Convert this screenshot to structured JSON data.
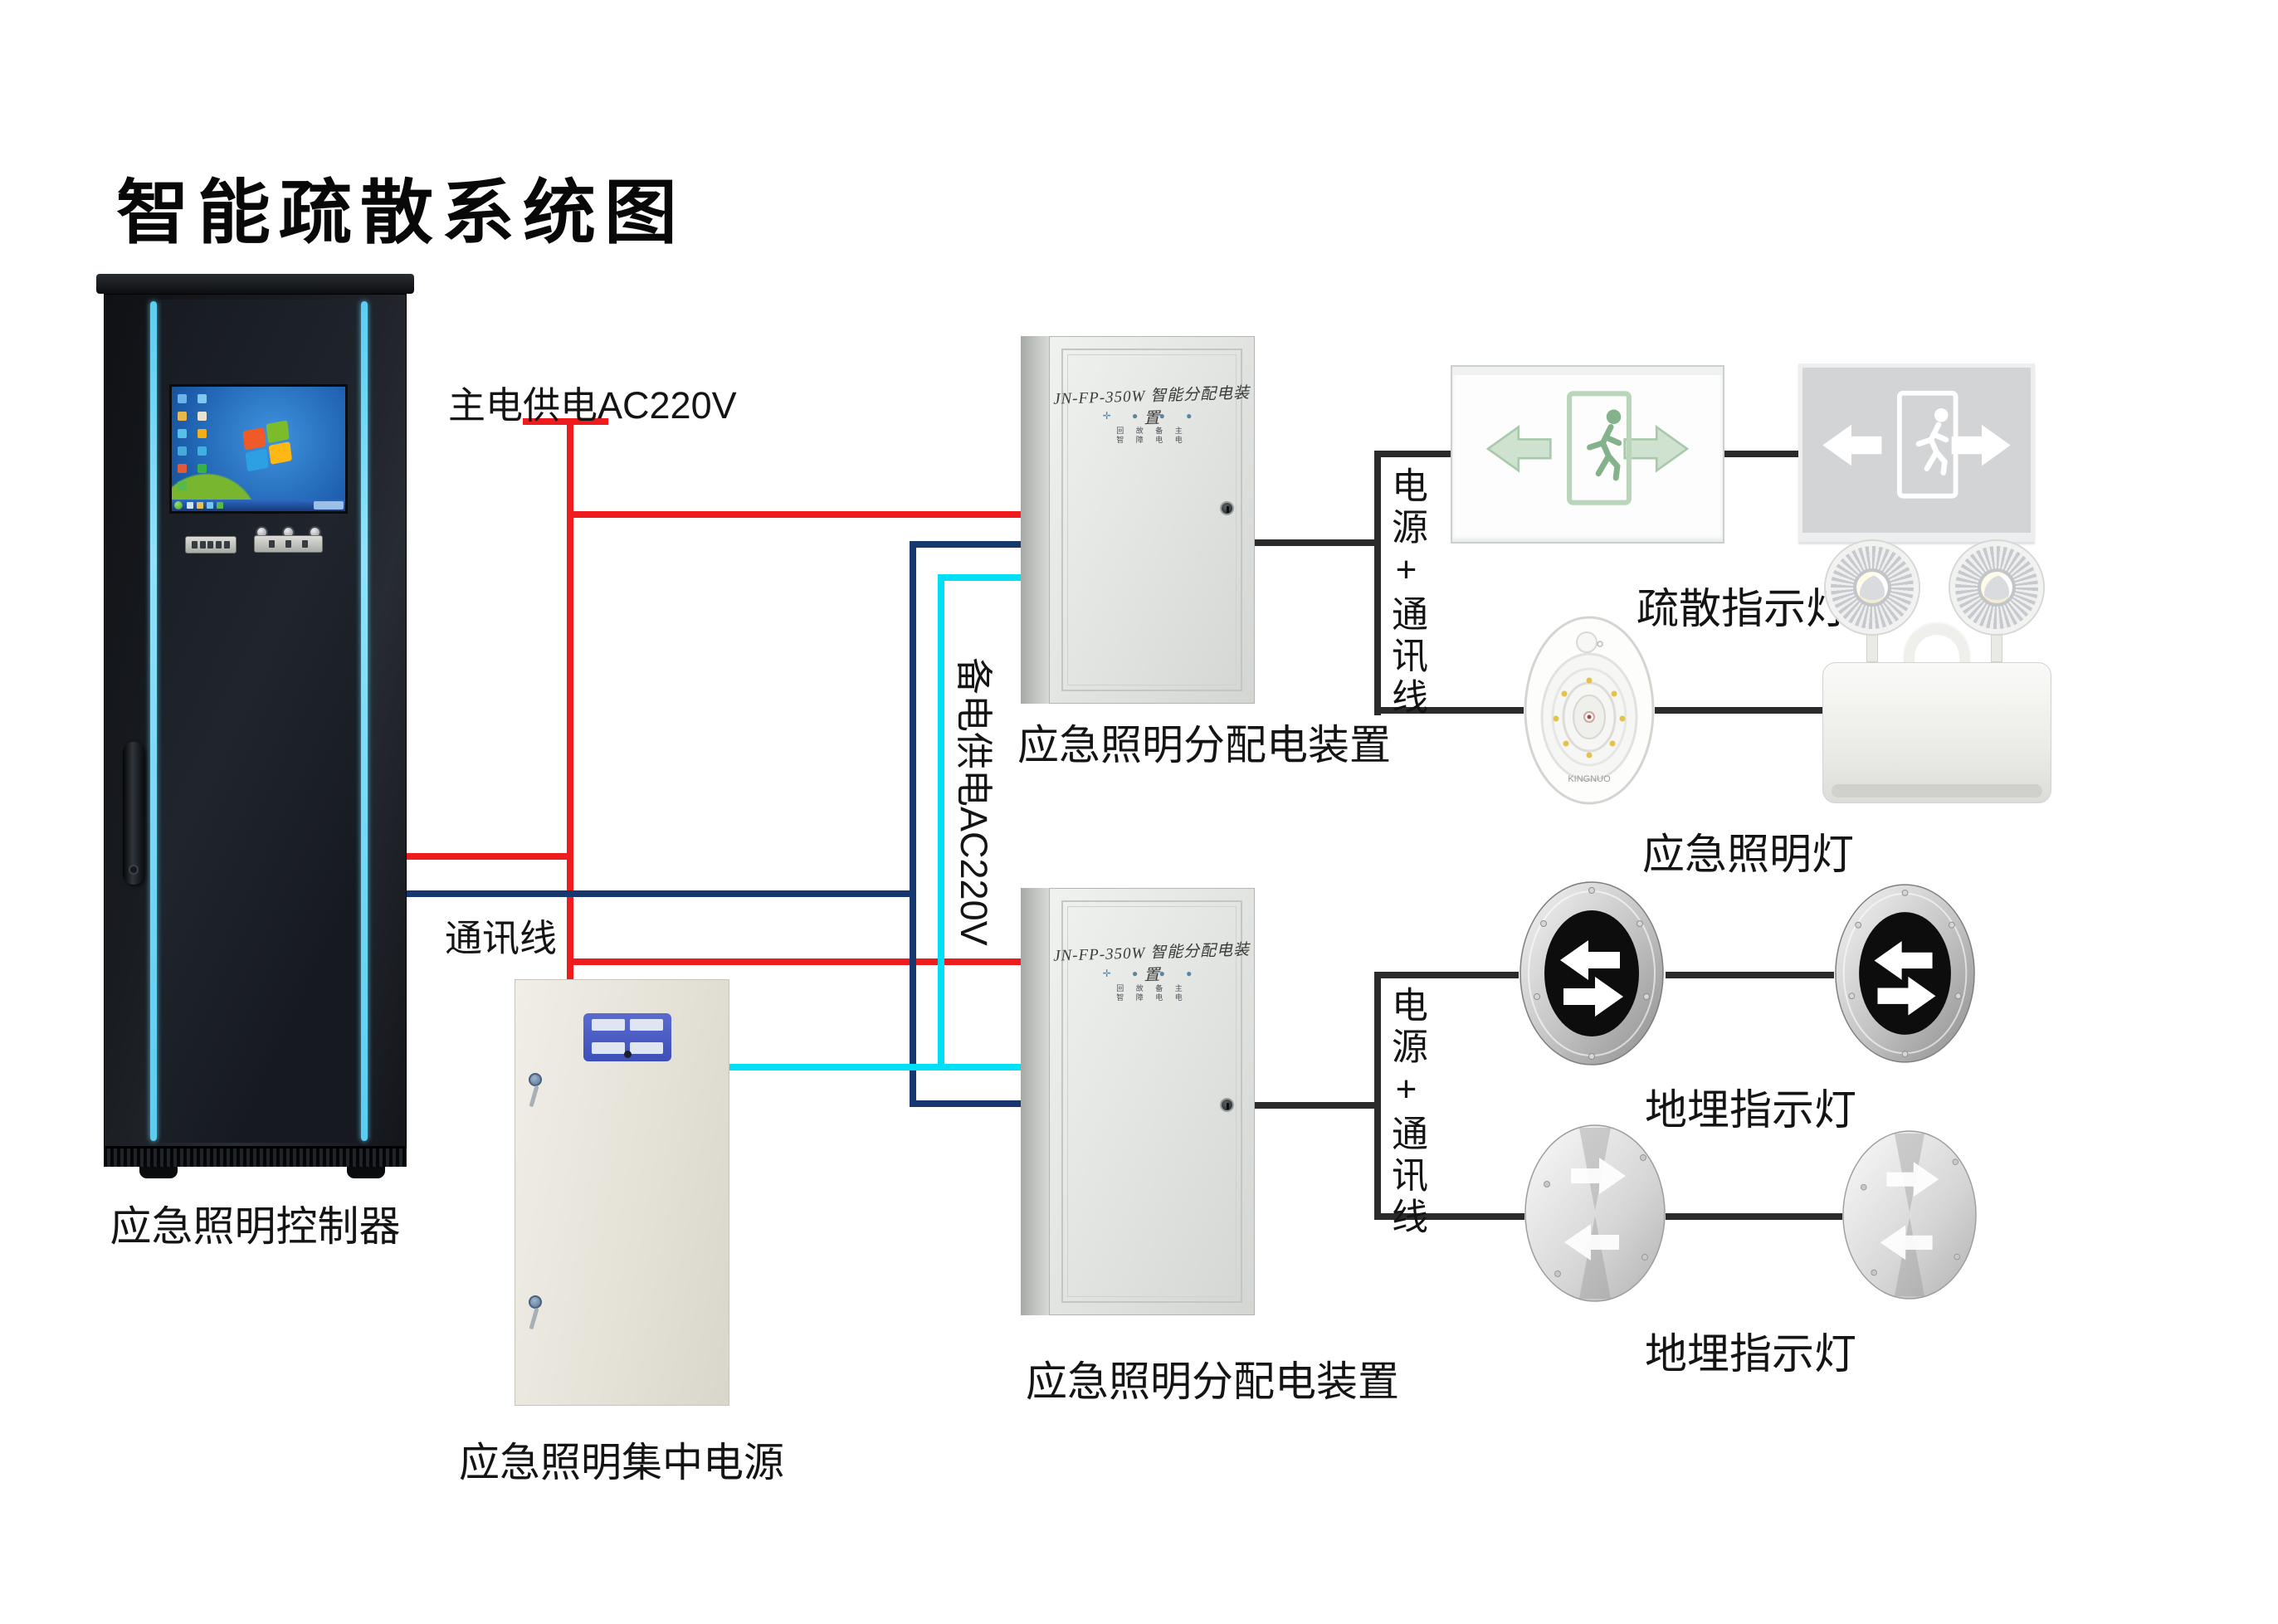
{
  "title": "智能疏散系统图",
  "annotations": {
    "main_power": "主电供电AC220V",
    "comm": "通讯线",
    "backup_power": "备电供电AC220V"
  },
  "cabinet": {
    "label": "应急照明控制器"
  },
  "central_power": {
    "label": "应急照明集中电源"
  },
  "dist_boxes": [
    {
      "model": "JN-FP-350W 智能分配电装置",
      "label": "应急照明分配电装置",
      "bus_label": "电源+通讯线",
      "led_rows": [
        "回 故 备 主",
        "智 障 电 电"
      ]
    },
    {
      "model": "JN-FP-350W 智能分配电装置",
      "label": "应急照明分配电装置",
      "bus_label": "电源+通讯线",
      "led_rows": [
        "回 故 备 主",
        "智 障 电 电"
      ]
    }
  ],
  "devices": {
    "exit_signs": {
      "label": "疏散指示灯"
    },
    "emergency_lamps": {
      "label": "应急照明灯",
      "brand": "KINGNUO"
    },
    "buried_lights_1": {
      "label": "地埋指示灯"
    },
    "buried_lights_2": {
      "label": "地埋指示灯"
    }
  },
  "colors": {
    "power": "#ee1c1c",
    "comm": "#17386e",
    "backup": "#00dff6",
    "connector": "#2b2b2b",
    "cabinet_accent": "#5bcdf2"
  }
}
